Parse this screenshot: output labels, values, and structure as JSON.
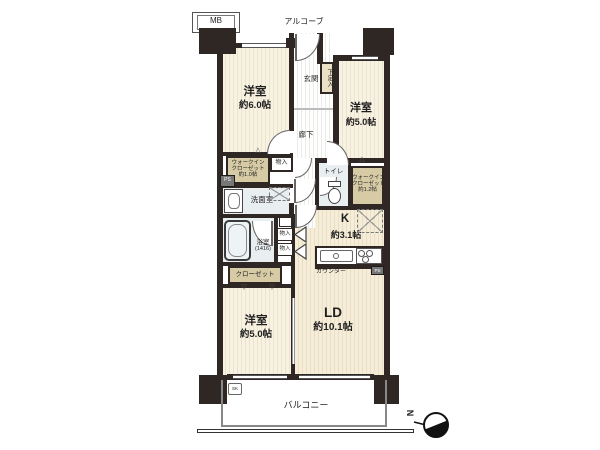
{
  "plan": {
    "mb": "MB",
    "alcove": "アルコーブ",
    "entrance": "玄関",
    "shoe_cabinet": "下足入",
    "hallway": "廊下",
    "bedroom1": {
      "name": "洋室",
      "size": "約6.0帖"
    },
    "bedroom2": {
      "name": "洋室",
      "size": "約5.0帖"
    },
    "bedroom3": {
      "name": "洋室",
      "size": "約5.0帖"
    },
    "living_dining": {
      "name": "LD",
      "size": "約10.1帖"
    },
    "kitchen": {
      "name": "K",
      "size": "約3.1帖"
    },
    "wic1": {
      "l1": "ウォークイン",
      "l2": "クローゼット",
      "l3": "約1.0帖"
    },
    "wic2": {
      "l1": "ウォークイン",
      "l2": "クローゼット",
      "l3": "約1.2帖"
    },
    "washroom": "洗面室",
    "toilet": "トイレ",
    "bathroom": {
      "name": "浴室",
      "size": "(1416)"
    },
    "closet": "クローゼット",
    "storage_hall": "物入",
    "storage_a": "物入",
    "storage_b": "物入",
    "counter": "カウンター",
    "balcony": "バルコニー",
    "ps_left": "PS",
    "ps_kitchen": "PS",
    "slop_sink": "SK",
    "north": "N",
    "icons": {
      "door_swing_up": "△",
      "door_swing_down": "▽"
    },
    "colors": {
      "wall": "#2e2723",
      "bedroom_floor": "#f8f2e3",
      "ld_floor": "#f5edd8",
      "closet": "#d7cba6",
      "wet_room": "#e9eef1",
      "shoe_box": "#eae1c6"
    }
  }
}
